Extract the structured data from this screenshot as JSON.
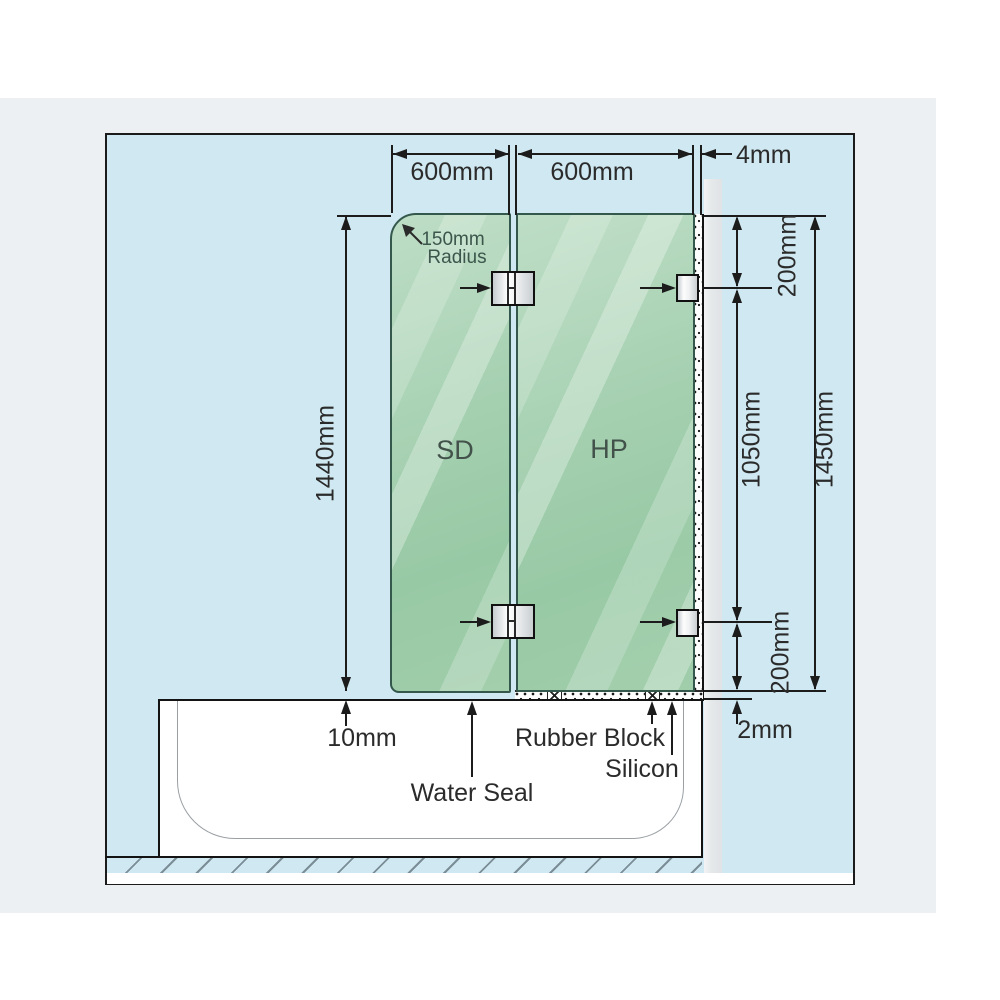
{
  "diagram_title": "over-bath shower screen installation diagram",
  "panels": {
    "sd": "SD",
    "hp": "HP"
  },
  "dims": {
    "width_sd": "600mm",
    "width_hp": "600mm",
    "wall_gap": "4mm",
    "height_sd": "1440mm",
    "offset_top": "200mm",
    "bracket_span": "1050mm",
    "height_hp": "1450mm",
    "offset_bottom": "200mm",
    "bottom_gap": "2mm",
    "tub_gap": "10mm",
    "radius_value": "150mm",
    "radius_word": "Radius"
  },
  "annotations": {
    "water_seal": "Water Seal",
    "rubber_block": "Rubber Block",
    "silicon": "Silicon"
  },
  "colors": {
    "diagram_background": "#cfe8f1",
    "glass_green": "#a7d1b2",
    "glass_edge": "#34584c",
    "outer_gray": "#edf0f3",
    "wall_gray": "#e4e7e9",
    "line_black": "#1c1c1c"
  }
}
